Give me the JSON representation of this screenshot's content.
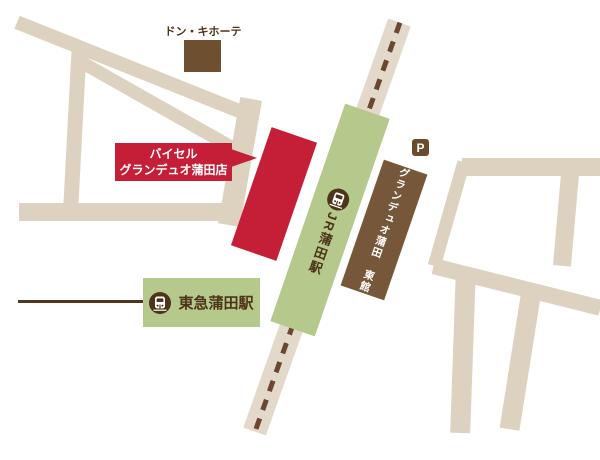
{
  "map": {
    "don_quijote_label": "ドン・キホーテ",
    "callout": {
      "line1": "バイセル",
      "line2": "グランデュオ蒲田店"
    },
    "jr_station_label": "JR蒲田駅",
    "granduo_east_label": "グランデュオ蒲田　東館",
    "tokyu_station_label": "東急蒲田駅",
    "parking_label": "P"
  },
  "colors": {
    "road": "#ddd2c0",
    "railway-band": "#e3d9cb",
    "railway-dash": "#6b4732",
    "green": "#b5c98c",
    "red": "#c41f37",
    "brown": "#76573a",
    "donki": "#6e5030",
    "dark": "#4d3317",
    "tokyu-line": "#53351d",
    "parking": "#6b4b2d"
  }
}
